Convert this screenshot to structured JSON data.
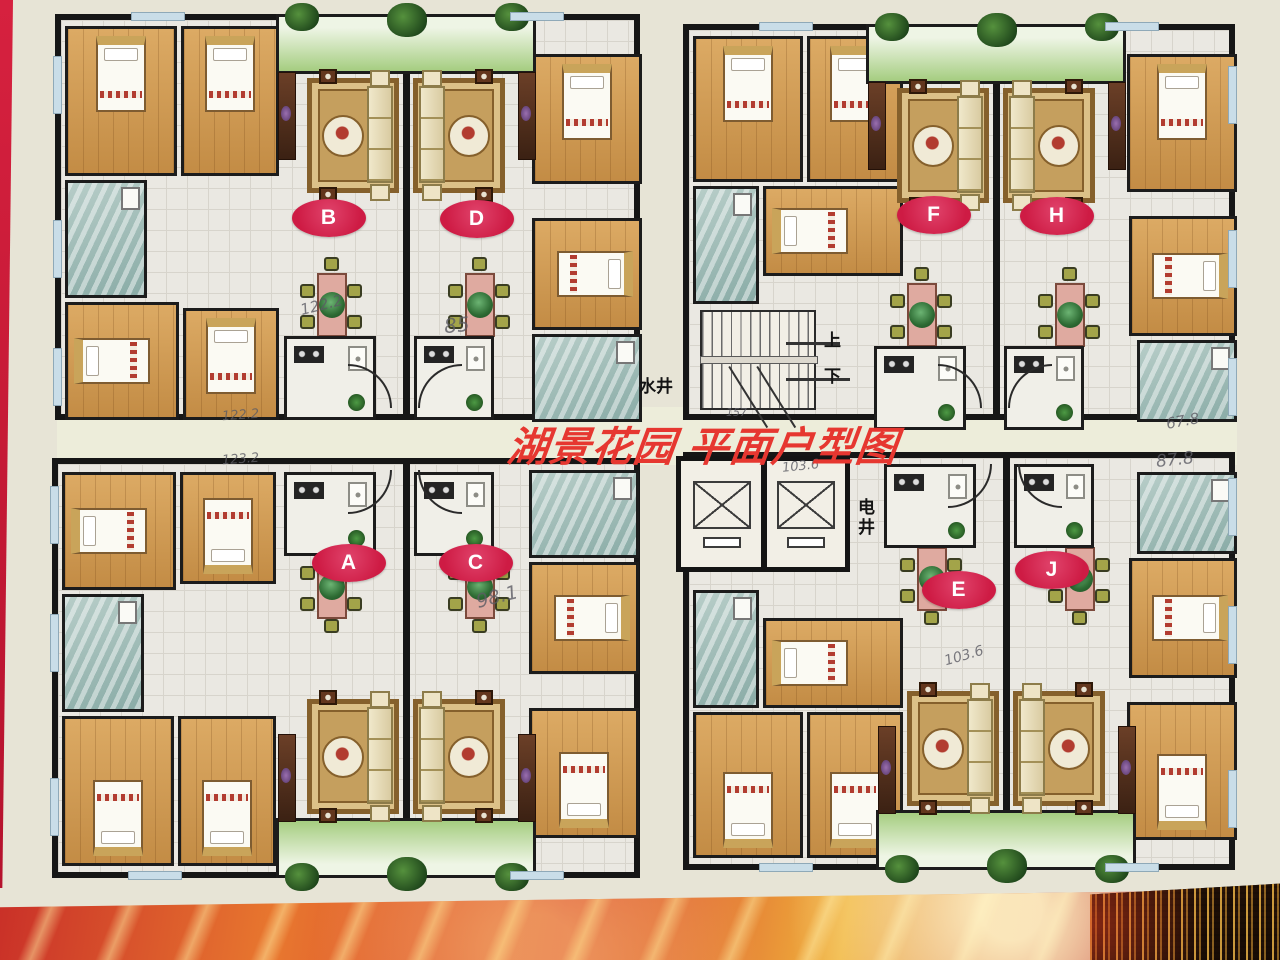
{
  "poster": {
    "title": "湖景花园 平面户型图"
  },
  "units": [
    {
      "id": "B"
    },
    {
      "id": "D"
    },
    {
      "id": "F"
    },
    {
      "id": "H"
    },
    {
      "id": "A"
    },
    {
      "id": "C"
    },
    {
      "id": "E"
    },
    {
      "id": "J"
    }
  ],
  "core": {
    "water_shaft": "水井",
    "electric_shaft": "电井",
    "stair_up": "上",
    "stair_down": "下"
  },
  "annotations": [
    {
      "text": "122.2"
    },
    {
      "text": "85"
    },
    {
      "text": "122.2"
    },
    {
      "text": "123.2"
    },
    {
      "text": "98.1"
    },
    {
      "text": "103.6"
    },
    {
      "text": "103.6"
    },
    {
      "text": "67.8"
    },
    {
      "text": "87.8"
    },
    {
      "text": "157"
    }
  ],
  "colors": {
    "accent_red": "#ce1b44",
    "title_red": "#e63730",
    "wall_black": "#161616",
    "wood_floor": "#d3a05f",
    "bath_teal": "#a8c2bd",
    "balcony_green": "#a5cd80"
  }
}
